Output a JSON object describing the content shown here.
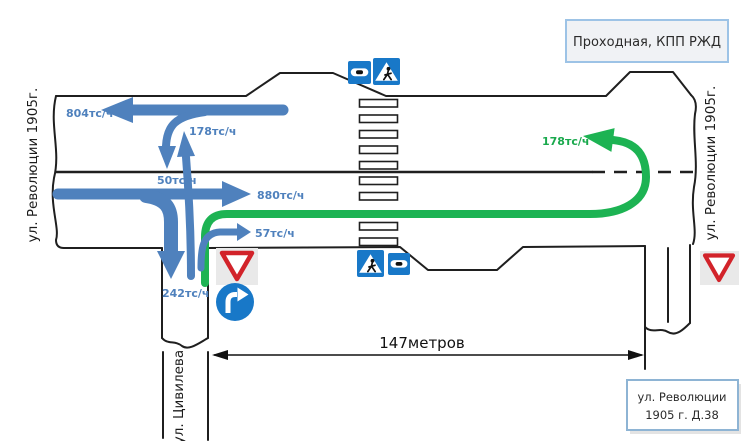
{
  "colors": {
    "flow_blue": "#4f81bd",
    "flow_green": "#1db353",
    "label_blue": "#4f81bd",
    "label_green": "#1aa94d",
    "sign_blue": "#1878c8",
    "sign_red": "#d2232a"
  },
  "streets": {
    "left": "ул. Революции 1905г.",
    "right": "ул. Революции 1905г.",
    "bottom": "ул. Цивилева"
  },
  "callouts": {
    "top_right": "Проходная, КПП РЖД",
    "bottom_right_line1": "ул. Революции",
    "bottom_right_line2": "1905 г. Д.38"
  },
  "flows": {
    "west_through": "804тс/ч",
    "side_to_north": "178тс/ч",
    "turn_into_side_from_west": "50тс/ч",
    "east_through": "880тс/ч",
    "side_right_turn": "57тс/ч",
    "into_side_street": "242тс/ч",
    "green_u_turn": "178тс/ч"
  },
  "dimension": {
    "label": "147метров"
  },
  "signs": [
    {
      "name": "speed-bump-sign"
    },
    {
      "name": "pedestrian-crossing-sign"
    },
    {
      "name": "pedestrian-crossing-sign"
    },
    {
      "name": "speed-bump-sign"
    },
    {
      "name": "yield-sign"
    },
    {
      "name": "mandatory-right-turn-sign"
    },
    {
      "name": "yield-sign"
    }
  ]
}
